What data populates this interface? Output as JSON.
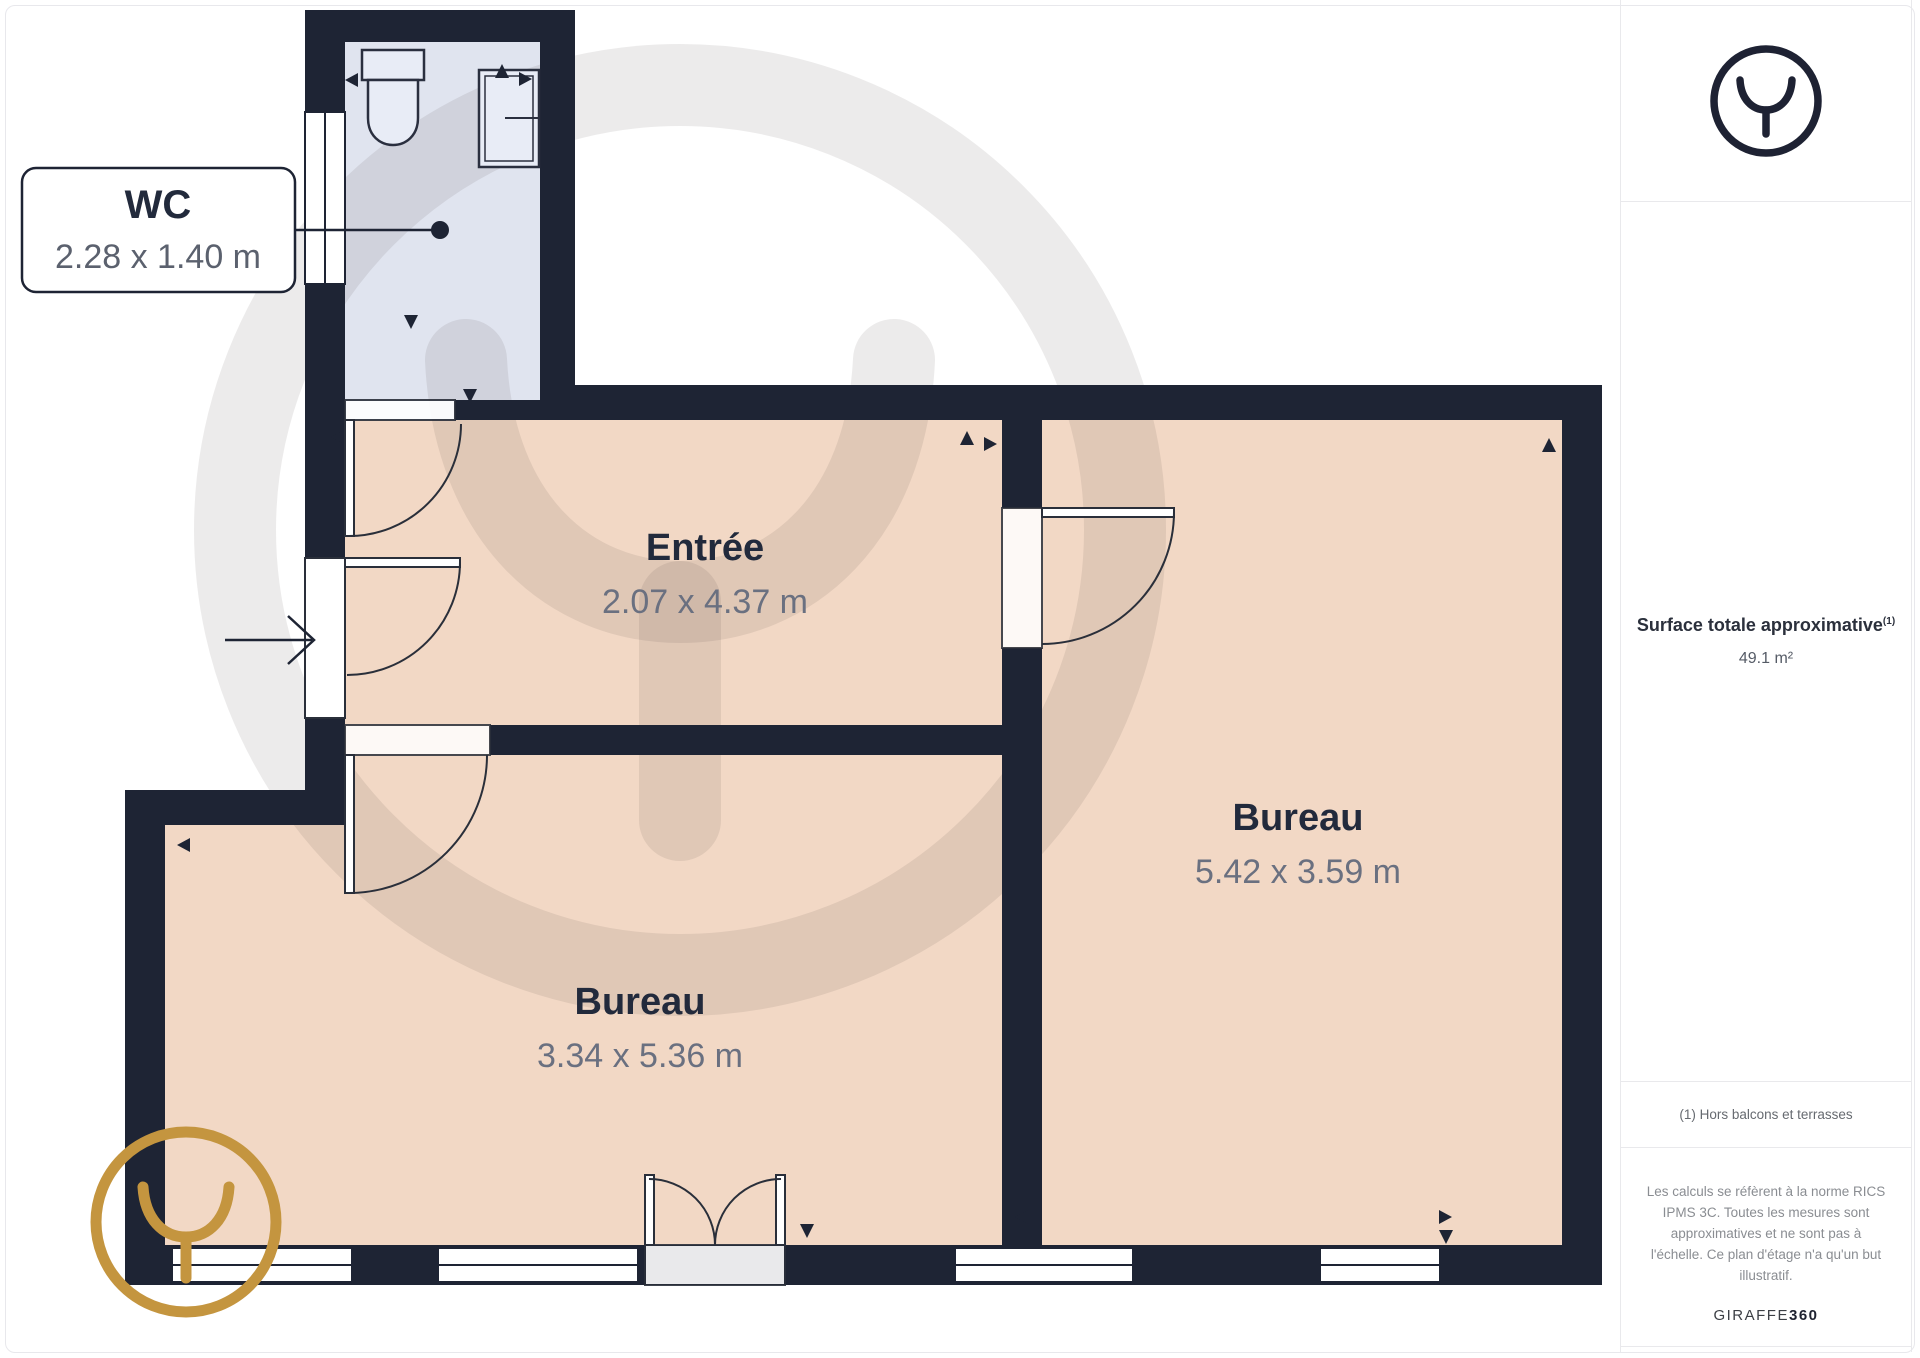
{
  "plan": {
    "callout": {
      "title": "WC",
      "dims": "2.28 x 1.40 m"
    },
    "rooms": [
      {
        "name": "Entrée",
        "dims": "2.07 x 4.37 m"
      },
      {
        "name": "Bureau",
        "dims": "5.42 x 3.59 m"
      },
      {
        "name": "Bureau",
        "dims": "3.34 x 5.36 m"
      }
    ],
    "colors": {
      "wall": "#1e2434",
      "floor": "#f2d8c5",
      "wc_floor": "#e0e4ef",
      "gold": "#c4953f",
      "title_text": "#222a3c",
      "dims_text": "#6a7080"
    }
  },
  "sidebar": {
    "surface_label": "Surface totale approximative",
    "surface_footnote_ref": "(1)",
    "surface_value": "49.1 m²",
    "footnote": "(1) Hors balcons et terrasses",
    "disclaimer": "Les calculs se réfèrent à la norme RICS IPMS 3C. Toutes les mesures sont approximatives et ne sont pas à l'échelle. Ce plan d'étage n'a qu'un but illustratif.",
    "brand": "GIRAFFE",
    "brand_suffix": "360"
  }
}
